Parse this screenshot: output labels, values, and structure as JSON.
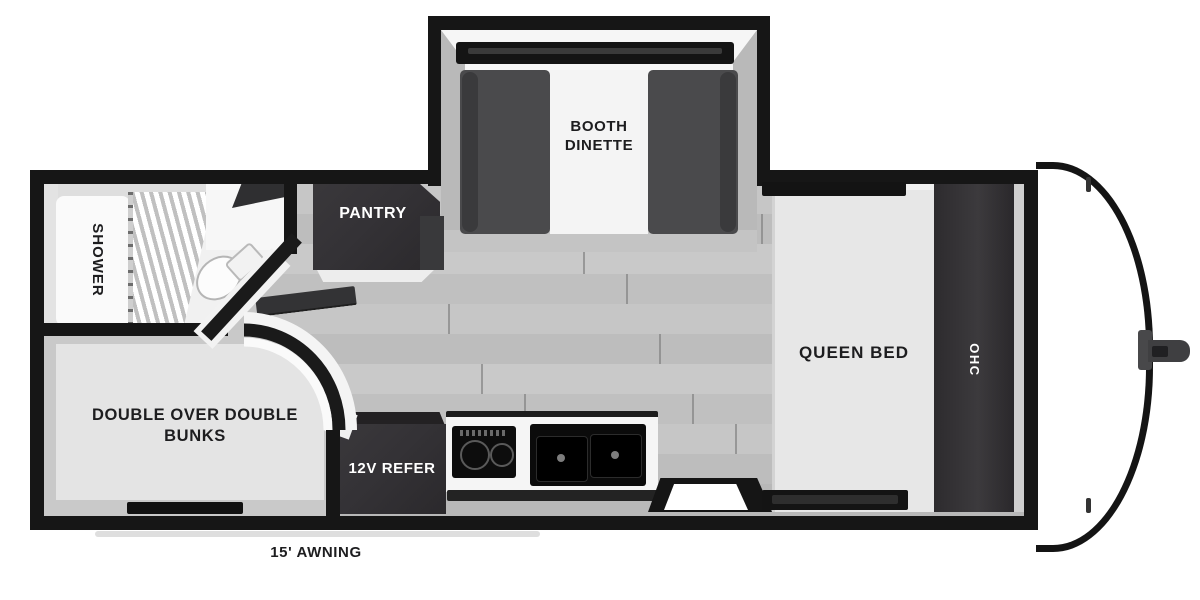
{
  "title": "Travel trailer floorplan",
  "labels": {
    "booth_dinette": "BOOTH DINETTE",
    "pantry": "PANTRY",
    "shower": "SHOWER",
    "queen_bed": "QUEEN BED",
    "ohc": "OHC",
    "bunks": "DOUBLE OVER DOUBLE BUNKS",
    "refrigerator": "12V REFER",
    "awning": "15' AWNING"
  },
  "colors": {
    "wall": "#161616",
    "floor": "#c2c2c2",
    "furniture": "#343236",
    "seat": "#4a4a4c",
    "bed": "#e7e7e7",
    "bath": "#f1f1f1",
    "label": "#1d1d1f",
    "label_light": "#ffffff",
    "cap": "#ffffff"
  }
}
